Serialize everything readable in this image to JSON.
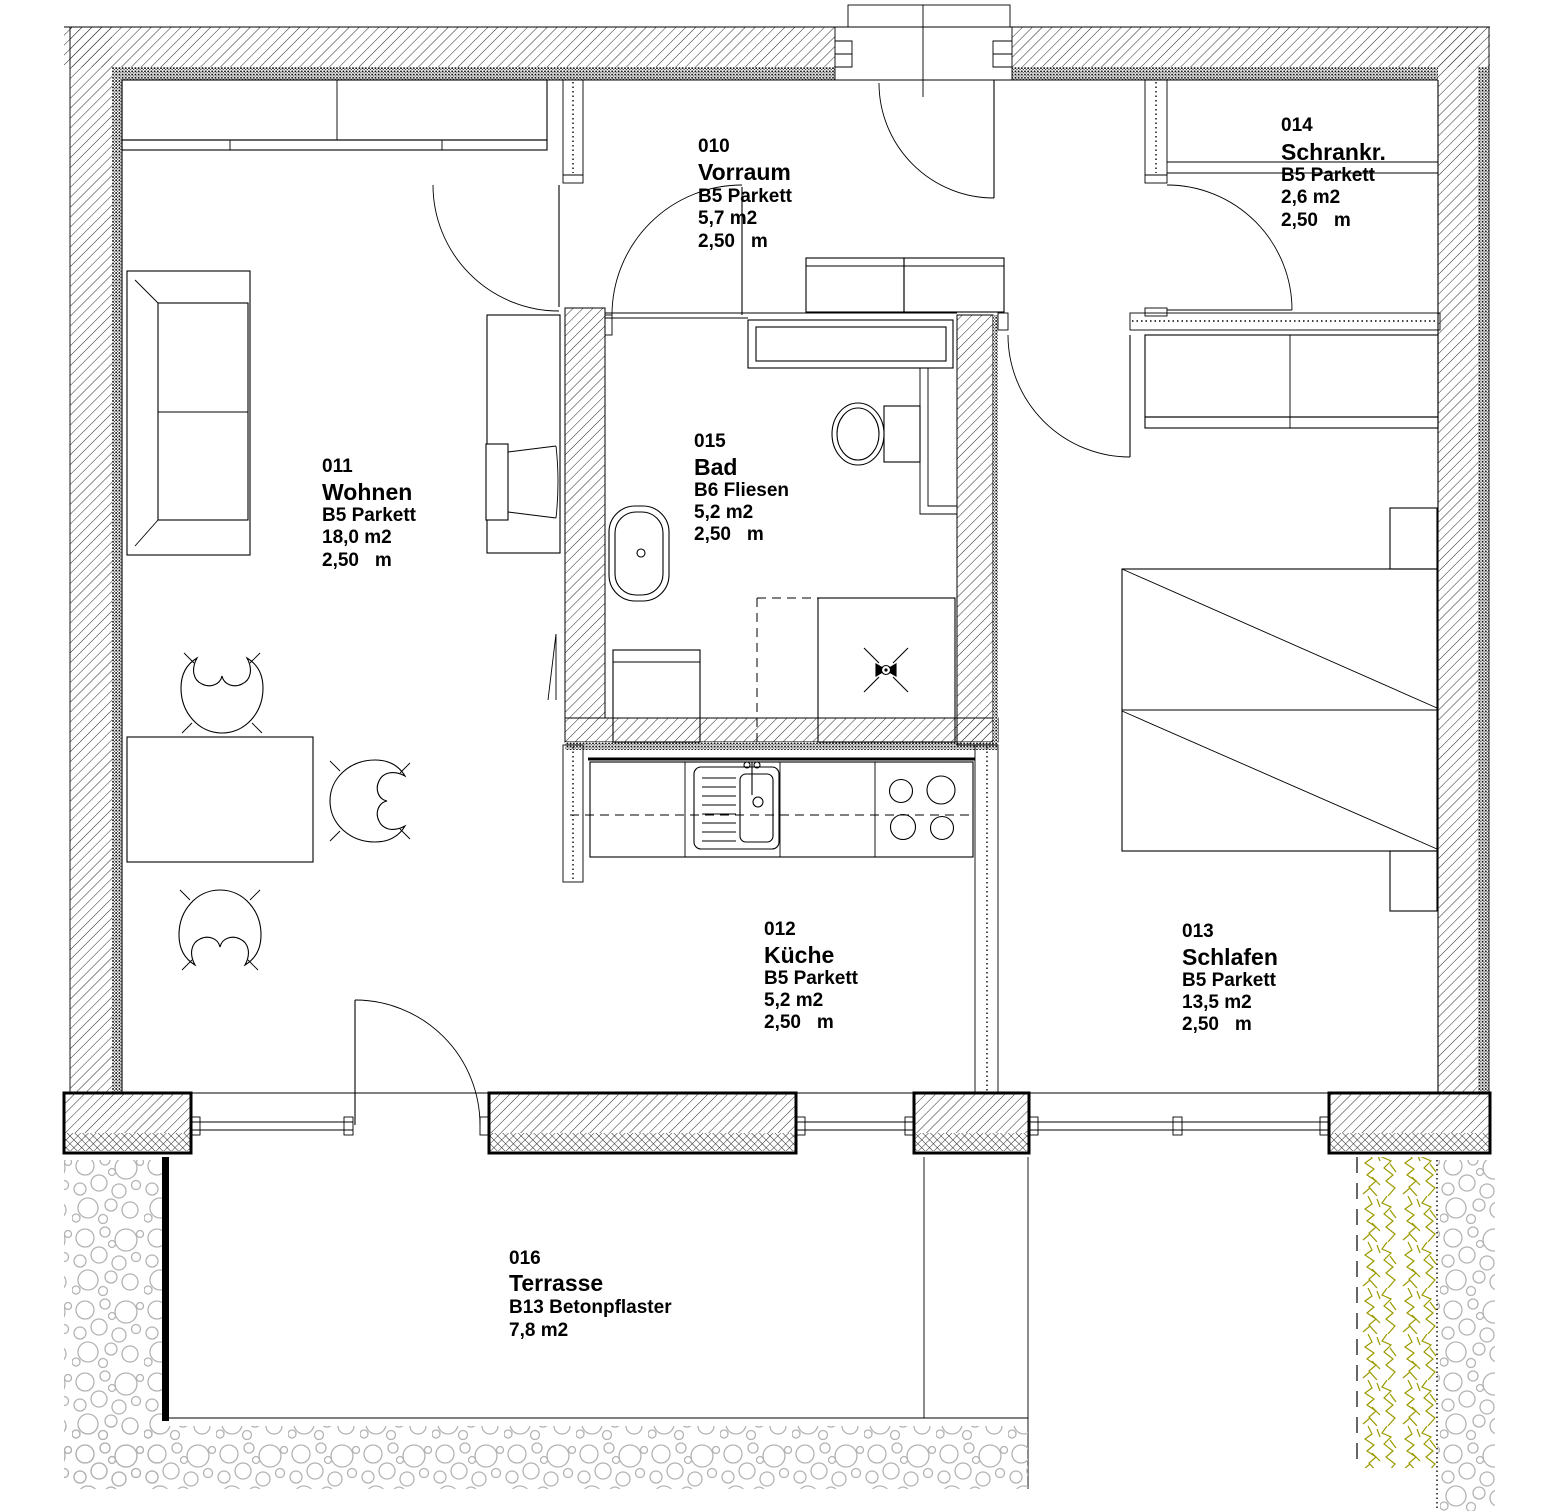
{
  "rooms": [
    {
      "id": "010",
      "name": "Vorraum",
      "floor": "B5 Parkett",
      "area": "5,7 m2",
      "height": "2,50   m"
    },
    {
      "id": "014",
      "name": "Schrankr.",
      "floor": "B5 Parkett",
      "area": "2,6 m2",
      "height": "2,50   m"
    },
    {
      "id": "011",
      "name": "Wohnen",
      "floor": "B5 Parkett",
      "area": "18,0 m2",
      "height": "2,50   m"
    },
    {
      "id": "015",
      "name": "Bad",
      "floor": "B6 Fliesen",
      "area": "5,2 m2",
      "height": "2,50   m"
    },
    {
      "id": "012",
      "name": "Küche",
      "floor": "B5 Parkett",
      "area": "5,2 m2",
      "height": "2,50   m"
    },
    {
      "id": "013",
      "name": "Schlafen",
      "floor": "B5 Parkett",
      "area": "13,5 m2",
      "height": "2,50   m"
    },
    {
      "id": "016",
      "name": "Terrasse",
      "floor": "B13 Betonpflaster",
      "area": "7,8 m2"
    }
  ],
  "colors": {
    "line": "#000000",
    "hedge": "#9a9a00",
    "gravel": "#b3b3b3",
    "paper": "#ffffff"
  }
}
